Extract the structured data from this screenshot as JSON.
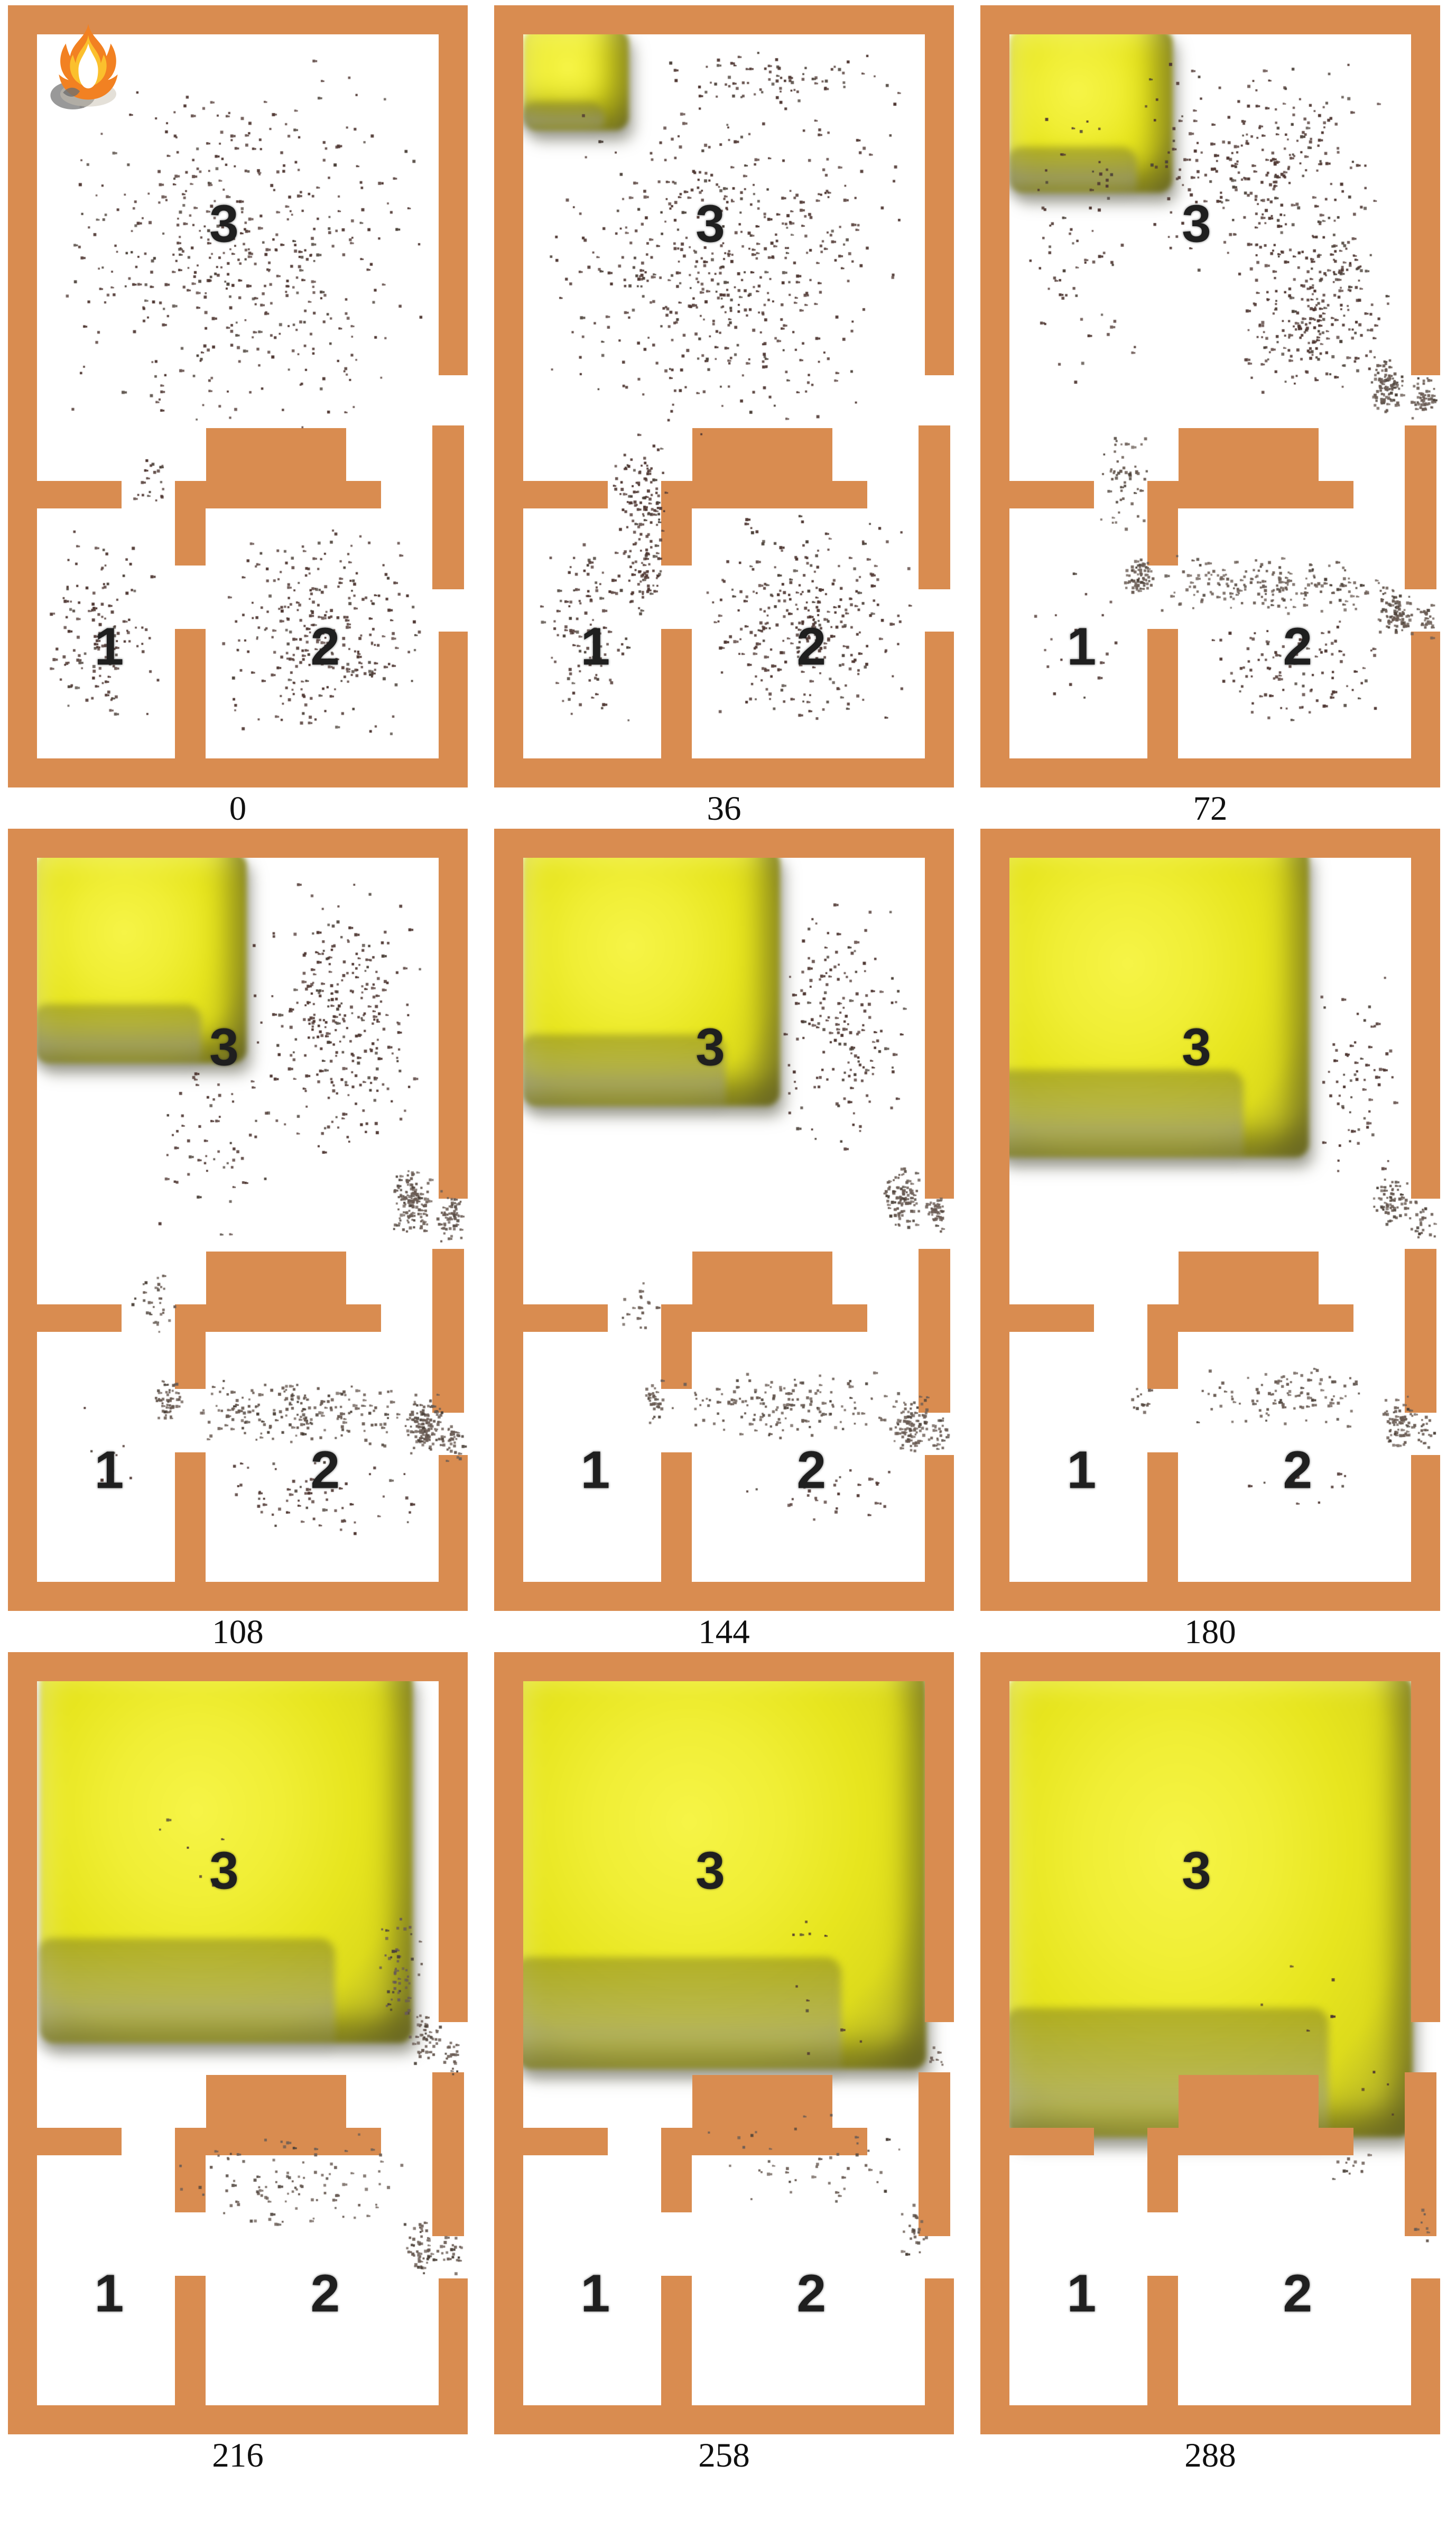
{
  "figure": {
    "description_visible_text_only": true,
    "rooms": {
      "top": "3",
      "bottom_left": "1",
      "bottom_right": "2"
    },
    "colors": {
      "wall": "#d98c50",
      "floor": "#ffffff",
      "dot_primary": "#4e3631",
      "dot_secondary": "#6a5c54",
      "dot_clump": "#4a4038",
      "smoke_core": "#f6f447",
      "smoke_mid": "#e7e51e",
      "smoke_edge": "#8c8a2e",
      "smoke_dark": "#4f4e12",
      "fire_orange": "#f28122",
      "fire_core": "#ffffff",
      "smoke_puff_gray": "#8e8e8e",
      "room_label_color": "#1f1f1f",
      "time_label_color": "#101010"
    },
    "dots_format": "[x_pct, y_pct, w_pct, h_pct, count, color_key(a=primary,b=secondary)]",
    "smoke_format": "[x_pct, y_pct, w_pct, h_pct]",
    "panels": [
      {
        "time": "0",
        "fire_icon": true,
        "smoke": null,
        "dots": [
          [
            9,
            6,
            82,
            50,
            480,
            "a"
          ],
          [
            26,
            57,
            9,
            7,
            20,
            "a"
          ],
          [
            8,
            66,
            25,
            27,
            130,
            "a"
          ],
          [
            45,
            66,
            46,
            28,
            290,
            "a"
          ]
        ]
      },
      {
        "time": "36",
        "fire_icon": false,
        "smoke": [
          6.3,
          3,
          23,
          13
        ],
        "dots": [
          [
            10,
            13,
            80,
            42,
            520,
            "a"
          ],
          [
            34,
            5,
            56,
            9,
            80,
            "a"
          ],
          [
            25,
            54,
            13,
            17,
            110,
            "a"
          ],
          [
            8,
            66,
            25,
            27,
            120,
            "a"
          ],
          [
            28,
            67,
            9,
            11,
            55,
            "a"
          ],
          [
            44,
            64,
            47,
            29,
            310,
            "a"
          ]
        ]
      },
      {
        "time": "72",
        "fire_icon": false,
        "smoke": [
          6.3,
          3,
          35.5,
          21
        ],
        "dots": [
          [
            34,
            6,
            56,
            28,
            280,
            "a"
          ],
          [
            54,
            28,
            37,
            22,
            260,
            "a"
          ],
          [
            8,
            9,
            28,
            40,
            70,
            "a"
          ],
          [
            84,
            44,
            8,
            9,
            90,
            "b"
          ],
          [
            93,
            47,
            6,
            6,
            45,
            "b"
          ],
          [
            25,
            54,
            12,
            13,
            55,
            "b"
          ],
          [
            31,
            70,
            7,
            6,
            65,
            "b"
          ],
          [
            38,
            70,
            52,
            8,
            190,
            "b"
          ],
          [
            86,
            74,
            8,
            7,
            90,
            "b"
          ],
          [
            94,
            76,
            5,
            5,
            25,
            "b"
          ],
          [
            46,
            78,
            44,
            14,
            100,
            "a"
          ],
          [
            9,
            68,
            23,
            24,
            18,
            "a"
          ]
        ]
      },
      {
        "time": "108",
        "fire_icon": false,
        "smoke": [
          6,
          3,
          46,
          27
        ],
        "dots": [
          [
            52,
            6,
            38,
            37,
            290,
            "a"
          ],
          [
            30,
            28,
            28,
            26,
            60,
            "a"
          ],
          [
            83,
            43,
            9,
            9,
            130,
            "b"
          ],
          [
            93,
            46,
            6,
            7,
            55,
            "b"
          ],
          [
            26,
            56,
            11,
            9,
            30,
            "b"
          ],
          [
            31,
            70,
            7,
            6,
            55,
            "b"
          ],
          [
            36,
            70,
            54,
            9,
            210,
            "b"
          ],
          [
            86,
            72,
            9,
            8,
            120,
            "b"
          ],
          [
            94,
            75,
            5,
            6,
            35,
            "b"
          ],
          [
            48,
            80,
            42,
            11,
            65,
            "a"
          ],
          [
            10,
            70,
            20,
            18,
            8,
            "a"
          ]
        ]
      },
      {
        "time": "144",
        "fire_icon": false,
        "smoke": [
          6.2,
          2.5,
          56,
          33
        ],
        "dots": [
          [
            60,
            8,
            30,
            35,
            170,
            "a"
          ],
          [
            84,
            43,
            9,
            8,
            100,
            "b"
          ],
          [
            93,
            46,
            6,
            6,
            40,
            "b"
          ],
          [
            38,
            69,
            52,
            9,
            160,
            "b"
          ],
          [
            32,
            70,
            6,
            6,
            32,
            "b"
          ],
          [
            86,
            72,
            9,
            8,
            95,
            "b"
          ],
          [
            94,
            74,
            5,
            6,
            25,
            "b"
          ],
          [
            52,
            80,
            38,
            9,
            30,
            "a"
          ],
          [
            27,
            57,
            10,
            8,
            18,
            "b"
          ]
        ]
      },
      {
        "time": "180",
        "fire_icon": false,
        "smoke": [
          3.5,
          2,
          68,
          40
        ],
        "dots": [
          [
            72,
            18,
            19,
            27,
            65,
            "a"
          ],
          [
            85,
            44,
            8,
            7,
            65,
            "b"
          ],
          [
            93,
            47,
            6,
            6,
            25,
            "b"
          ],
          [
            44,
            68,
            46,
            9,
            100,
            "b"
          ],
          [
            87,
            72,
            8,
            8,
            70,
            "b"
          ],
          [
            94,
            74,
            5,
            6,
            20,
            "b"
          ],
          [
            32,
            70,
            5,
            5,
            12,
            "b"
          ],
          [
            56,
            80,
            28,
            7,
            10,
            "a"
          ]
        ]
      },
      {
        "time": "216",
        "fire_icon": false,
        "smoke": [
          7,
          2,
          81,
          48
        ],
        "dots": [
          [
            79,
            32,
            13,
            16,
            55,
            "b"
          ],
          [
            87,
            46,
            7,
            7,
            45,
            "b"
          ],
          [
            94,
            49,
            5,
            5,
            20,
            "b"
          ],
          [
            30,
            61,
            58,
            13,
            100,
            "b"
          ],
          [
            86,
            72,
            8,
            8,
            55,
            "b"
          ],
          [
            94,
            74,
            5,
            6,
            18,
            "b"
          ],
          [
            28,
            20,
            22,
            14,
            6,
            "a"
          ]
        ]
      },
      {
        "time": "258",
        "fire_icon": false,
        "smoke": [
          5,
          2.3,
          89,
          51
        ],
        "dots": [
          [
            46,
            58,
            44,
            13,
            45,
            "b"
          ],
          [
            87,
            70,
            8,
            8,
            25,
            "b"
          ],
          [
            94,
            50,
            4,
            5,
            8,
            "b"
          ],
          [
            55,
            28,
            22,
            16,
            6,
            "a"
          ],
          [
            64,
            44,
            18,
            10,
            5,
            "a"
          ]
        ]
      },
      {
        "time": "288",
        "fire_icon": false,
        "smoke": [
          6,
          3,
          88,
          59
        ],
        "dots": [
          [
            74,
            62,
            18,
            7,
            12,
            "b"
          ],
          [
            93,
            70,
            5,
            6,
            8,
            "b"
          ],
          [
            58,
            38,
            26,
            16,
            5,
            "a"
          ],
          [
            80,
            52,
            12,
            8,
            4,
            "a"
          ]
        ]
      }
    ]
  }
}
